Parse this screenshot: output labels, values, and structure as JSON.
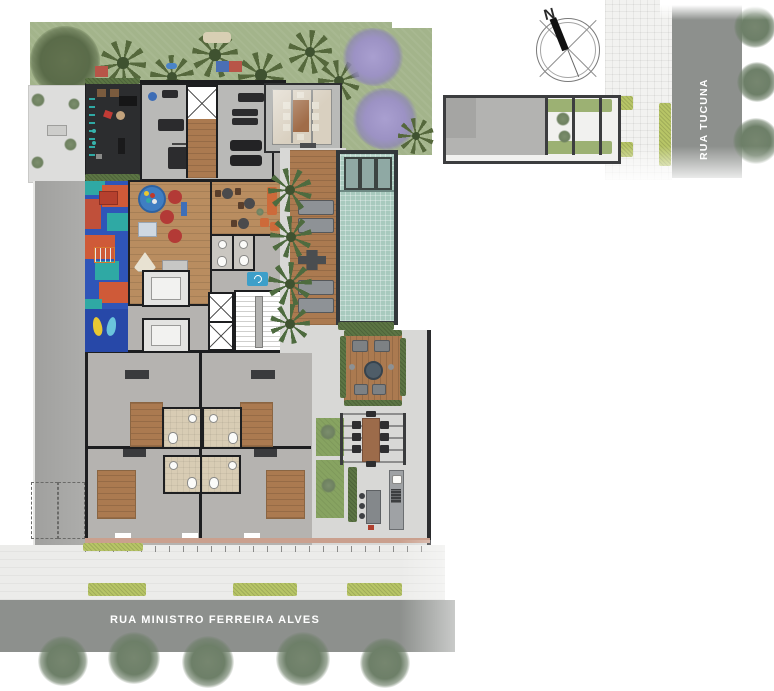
{
  "streets": {
    "tucuna": "RUA TUCUNA",
    "ferreira_alves": "RUA MINISTRO FERREIRA ALVES"
  },
  "compass": {
    "north_label": "N"
  },
  "areas": [
    "garden-playground-north",
    "outdoor-gym-terrace",
    "indoor-gym",
    "kids-playroom",
    "lounge-cafe",
    "restrooms",
    "elevator-core",
    "staircase",
    "glass-roof-dining-room",
    "pool",
    "pool-wood-deck",
    "fire-pit-lounge-deck",
    "pergola-dining",
    "bbq-grill-area",
    "color-playground-west",
    "residential-units",
    "parking-spaces",
    "driveway-gate"
  ],
  "colors": {
    "lawn": "#a3b48b",
    "lawn_dark": "#87a361",
    "street": "#8d908d",
    "sidewalk": "#ececea",
    "concrete": "#b5b3b0",
    "building_wall": "#1d1e20",
    "wood_deck": "#ab7a50",
    "room_wood": "#b98d60",
    "pool_water": "#a8cabe",
    "pool_rim": "#33383b",
    "playground_blue": "#2f55b8",
    "playground_orange": "#cf5a38",
    "playground_teal": "#2fa9a4",
    "hedge_green": "#5c7544",
    "hedge_yellow": "#b7c566",
    "jacaranda_purple": "#9c92c4",
    "palm_green": "#55683c",
    "street_tree": "#74846e",
    "sign_blue": "#3d9fc9",
    "sofa_orange": "#cd6a3a",
    "bathroom_tan": "#d8ccb4"
  }
}
